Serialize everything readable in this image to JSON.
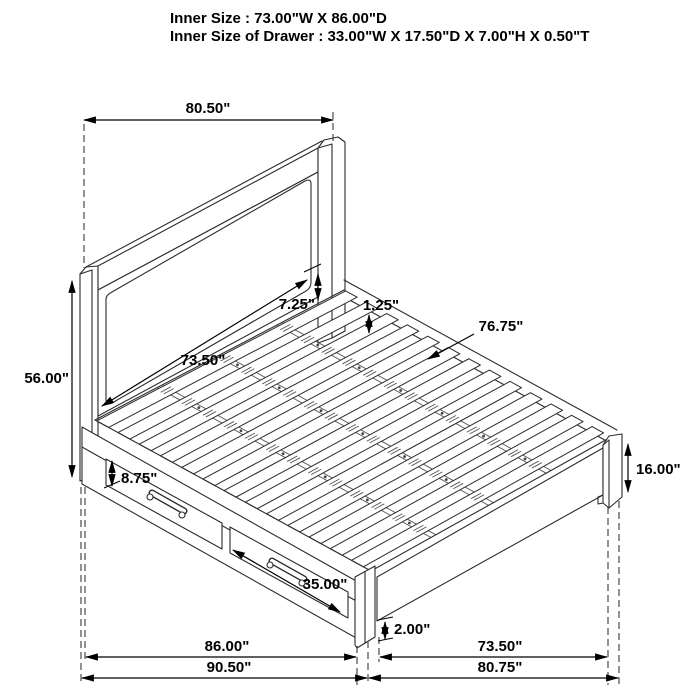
{
  "header": {
    "line1": "Inner Size : 73.00\"W X 86.00\"D",
    "line2": "Inner Size of Drawer : 33.00\"W X 17.50\"D X 7.00\"H X 0.50\"T"
  },
  "dimensions": {
    "headboard_width": "80.50\"",
    "headboard_height": "56.00\"",
    "headboard_panel_width": "73.50\"",
    "headboard_post_exposed": "7.25\"",
    "slat_recess": "1.25\"",
    "side_rail_length": "76.75\"",
    "drawer_front_height": "8.75\"",
    "drawer_front_width": "35.00\"",
    "footboard_height": "16.00\"",
    "leg_height": "2.00\"",
    "storage_base_length": "86.00\"",
    "foot_span": "73.50\"",
    "overall_length": "90.50\"",
    "overall_width": "80.75\""
  },
  "colors": {
    "line": "#2b2b2b",
    "dimension": "#000000",
    "background": "#ffffff"
  }
}
